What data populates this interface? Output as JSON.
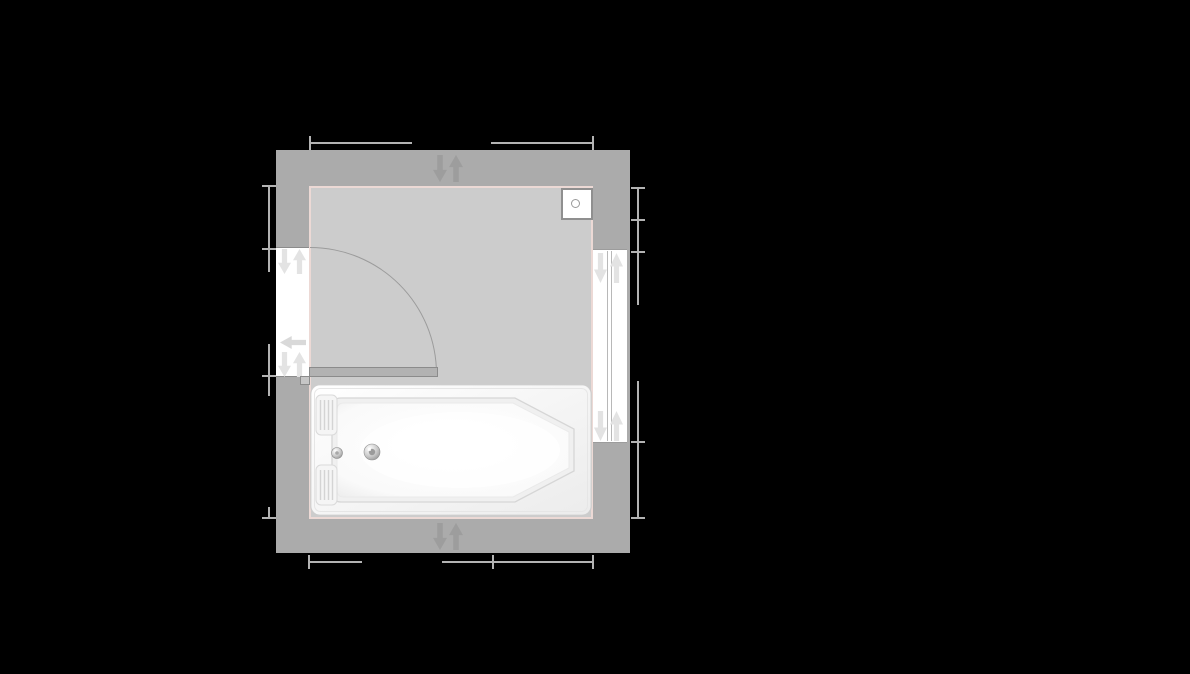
{
  "app": {
    "type": "floor-plan-editor-canvas",
    "canvas": {
      "width": 1190,
      "height": 674,
      "background": "#000000"
    },
    "visible_text": "none"
  },
  "palette": {
    "wall": "#ababab",
    "floor": "#cccccc",
    "floor_outline": "#ecd9d5",
    "wall_handle_arrow": "#9d9d9d",
    "opening_handle_arrow": "#e3e3e3",
    "swing_direction_arrow": "#d9d9d9",
    "dimension_line": "#b3b3b3",
    "door_leaf": "#b2b2b2",
    "dark_outline": "#8b8b8b",
    "fixture_border": "#8f8f8f",
    "white": "#ffffff"
  },
  "icons": {
    "wall_handles": "move-down-up-arrow-pair",
    "door_handles": "move-down-up-arrow-pair",
    "door_swing": "arrow-left",
    "window_handles": "move-down-up-arrow-pair"
  },
  "room": {
    "walls": {
      "x": 276,
      "y": 150,
      "w": 354,
      "h": 403,
      "bg": "#ababab"
    },
    "floor": {
      "x": 309,
      "y": 186,
      "w": 284,
      "h": 333,
      "bg": "#cccccc"
    }
  },
  "wall_handles": {
    "top_down": {
      "x": 433,
      "y": 155,
      "w": 14,
      "h": 27
    },
    "top_up": {
      "x": 449,
      "y": 155,
      "w": 14,
      "h": 27
    },
    "bottom_down": {
      "x": 433,
      "y": 523,
      "w": 14,
      "h": 27
    },
    "bottom_up": {
      "x": 449,
      "y": 523,
      "w": 14,
      "h": 27
    }
  },
  "door": {
    "opening": {
      "x": 276,
      "y": 247,
      "w": 33,
      "h": 130,
      "bg": "#ffffff"
    },
    "leaf": {
      "x": 309,
      "y": 367,
      "w": 129,
      "h": 10,
      "bg": "#b2b2b2"
    },
    "hinge": {
      "x": 300,
      "y": 376,
      "w": 10,
      "h": 9,
      "bg": "#c6c6c6"
    },
    "swing_arc": {
      "x": 310,
      "y": 247,
      "w": 127,
      "h": 127
    },
    "handles": {
      "top_down": {
        "x": 278,
        "y": 249,
        "w": 13,
        "h": 25
      },
      "top_up": {
        "x": 293,
        "y": 249,
        "w": 13,
        "h": 25
      },
      "swing_left": {
        "x": 280,
        "y": 336,
        "w": 26,
        "h": 13
      },
      "bottom_down": {
        "x": 278,
        "y": 352,
        "w": 13,
        "h": 25
      },
      "bottom_up": {
        "x": 293,
        "y": 352,
        "w": 13,
        "h": 25
      }
    }
  },
  "window": {
    "frame": {
      "x": 593,
      "y": 249,
      "w": 34,
      "h": 194,
      "bg": "#ffffff"
    },
    "panes": [
      {
        "x": 607,
        "y": 251,
        "w": 1,
        "h": 190
      },
      {
        "x": 611,
        "y": 251,
        "w": 1,
        "h": 190
      }
    ],
    "handles": {
      "top_down": {
        "x": 594,
        "y": 253,
        "w": 13,
        "h": 30
      },
      "top_up": {
        "x": 610,
        "y": 253,
        "w": 13,
        "h": 30
      },
      "bottom_down": {
        "x": 594,
        "y": 411,
        "w": 13,
        "h": 30
      },
      "bottom_up": {
        "x": 610,
        "y": 411,
        "w": 13,
        "h": 30
      }
    }
  },
  "corner_fixture": {
    "box": {
      "x": 561,
      "y": 188,
      "w": 32,
      "h": 32,
      "bg": "#ffffff"
    },
    "knob": {
      "x": 571,
      "y": 199,
      "w": 9,
      "h": 9
    }
  },
  "bathtub": {
    "body": {
      "x": 310,
      "y": 384,
      "w": 282,
      "h": 132
    },
    "drain": {
      "cx": 62,
      "cy": 68,
      "r": 8
    },
    "overflow": {
      "cx": 27,
      "cy": 69,
      "r": 5.5
    }
  },
  "dims": {
    "color": "#b3b3b3",
    "top": {
      "segments": [
        {
          "x": 310,
          "y": 142,
          "w": 102,
          "h": 2
        },
        {
          "x": 491,
          "y": 142,
          "w": 102,
          "h": 2
        }
      ],
      "ticks": [
        {
          "x": 309,
          "y": 136,
          "w": 2,
          "h": 14
        },
        {
          "x": 592,
          "y": 136,
          "w": 2,
          "h": 14
        }
      ]
    },
    "bottom": {
      "segments": [
        {
          "x": 309,
          "y": 561,
          "w": 53,
          "h": 2
        },
        {
          "x": 442,
          "y": 561,
          "w": 151,
          "h": 2
        }
      ],
      "ticks": [
        {
          "x": 308,
          "y": 555,
          "w": 2,
          "h": 14
        },
        {
          "x": 492,
          "y": 555,
          "w": 2,
          "h": 14
        },
        {
          "x": 592,
          "y": 555,
          "w": 2,
          "h": 14
        }
      ]
    },
    "left": {
      "segments": [
        {
          "x": 268,
          "y": 186,
          "w": 2,
          "h": 86
        },
        {
          "x": 268,
          "y": 344,
          "w": 2,
          "h": 52
        },
        {
          "x": 268,
          "y": 507,
          "w": 2,
          "h": 12
        }
      ],
      "ticks": [
        {
          "x": 262,
          "y": 185,
          "w": 14,
          "h": 2
        },
        {
          "x": 262,
          "y": 248,
          "w": 14,
          "h": 2
        },
        {
          "x": 262,
          "y": 375,
          "w": 14,
          "h": 2
        },
        {
          "x": 262,
          "y": 517,
          "w": 14,
          "h": 2
        }
      ]
    },
    "right": {
      "segments": [
        {
          "x": 637,
          "y": 188,
          "w": 2,
          "h": 117
        },
        {
          "x": 637,
          "y": 381,
          "w": 2,
          "h": 137
        }
      ],
      "ticks": [
        {
          "x": 631,
          "y": 187,
          "w": 14,
          "h": 2
        },
        {
          "x": 631,
          "y": 219,
          "w": 14,
          "h": 2
        },
        {
          "x": 631,
          "y": 251,
          "w": 14,
          "h": 2
        },
        {
          "x": 631,
          "y": 441,
          "w": 14,
          "h": 2
        },
        {
          "x": 631,
          "y": 517,
          "w": 14,
          "h": 2
        }
      ]
    }
  }
}
